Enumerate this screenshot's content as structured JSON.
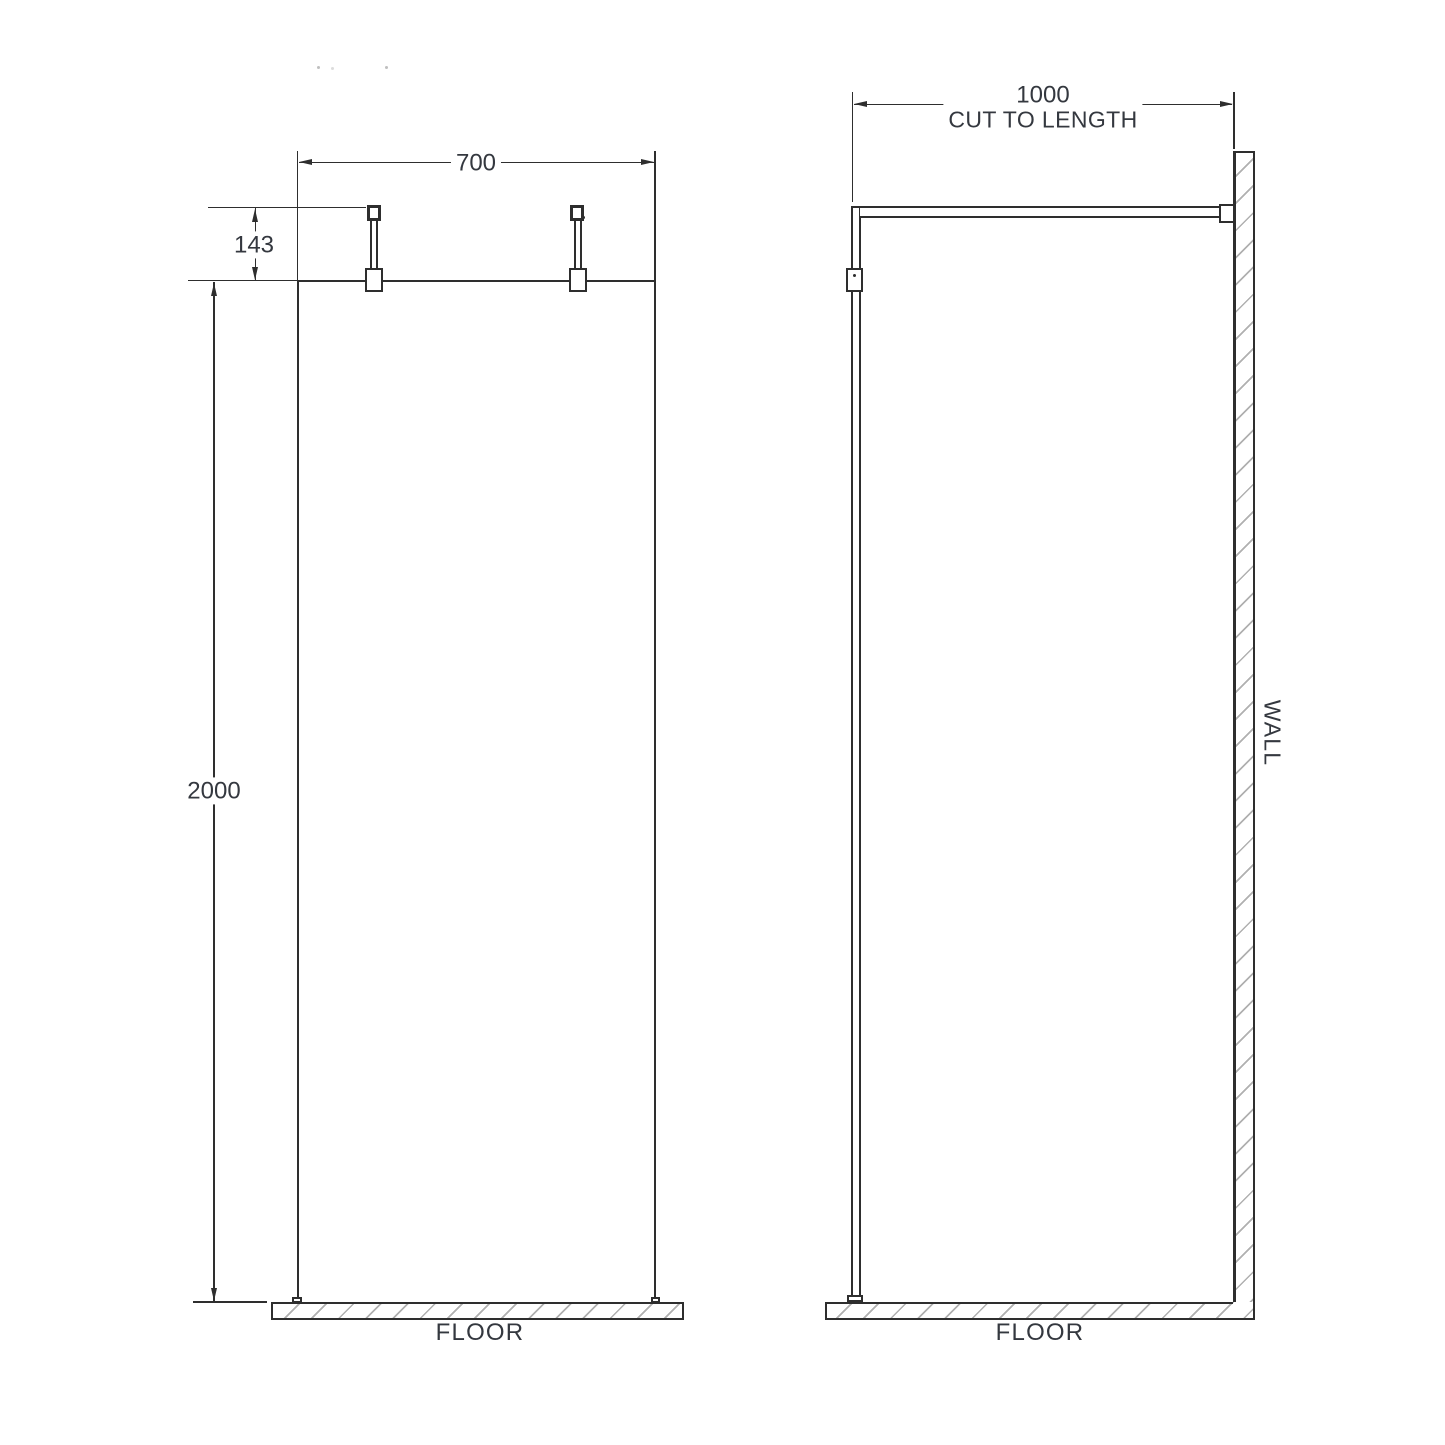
{
  "front_view": {
    "width_dim": "700",
    "bracket_drop_dim": "143",
    "height_dim": "2000",
    "floor_label": "FLOOR"
  },
  "side_view": {
    "depth_dim": "1000",
    "depth_note": "CUT TO LENGTH",
    "wall_label": "WALL",
    "floor_label": "FLOOR"
  },
  "colors": {
    "line": "#2e2e2e",
    "text": "#34383f",
    "hatch": "#b0b0b0"
  }
}
